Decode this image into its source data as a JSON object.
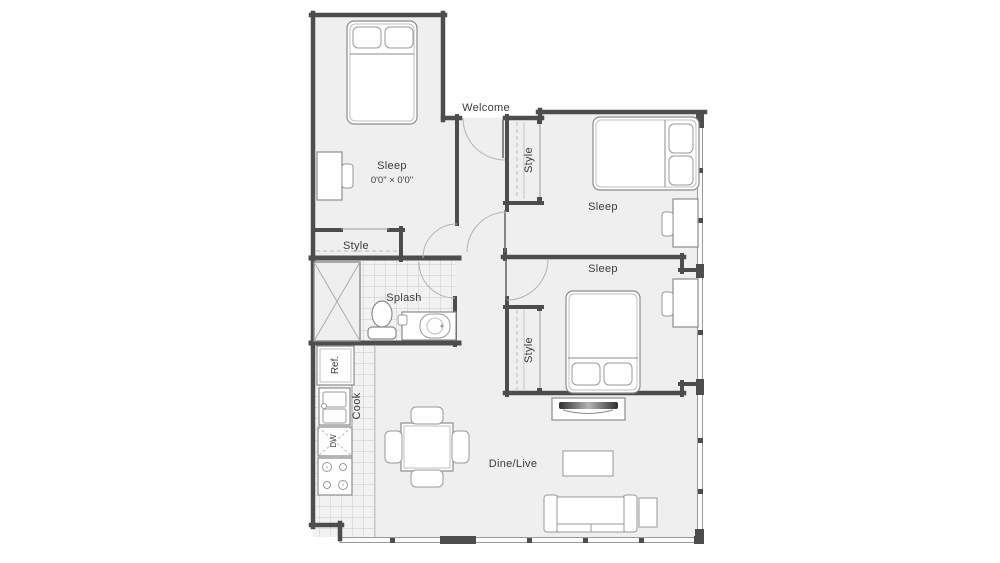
{
  "floor_plan": {
    "entry": {
      "label": "Welcome"
    },
    "bedroom_1": {
      "label": "Sleep",
      "dimensions": "0'0\" × 0'0\"",
      "closet_label": "Style"
    },
    "bedroom_2": {
      "label": "Sleep",
      "closet_label": "Style"
    },
    "bedroom_3": {
      "label": "Sleep",
      "closet_label": "Style"
    },
    "bathroom": {
      "label": "Splash"
    },
    "kitchen": {
      "label": "Cook",
      "refrigerator_label": "Ref.",
      "dishwasher_label": "DW"
    },
    "living_dining": {
      "label": "Dine/Live"
    },
    "colors": {
      "wall": "#4d4d4d",
      "floor": "#efefef",
      "furniture_line": "#8c8c8c",
      "tile_line": "#c9c9c9",
      "text": "#3b3b3b"
    }
  }
}
